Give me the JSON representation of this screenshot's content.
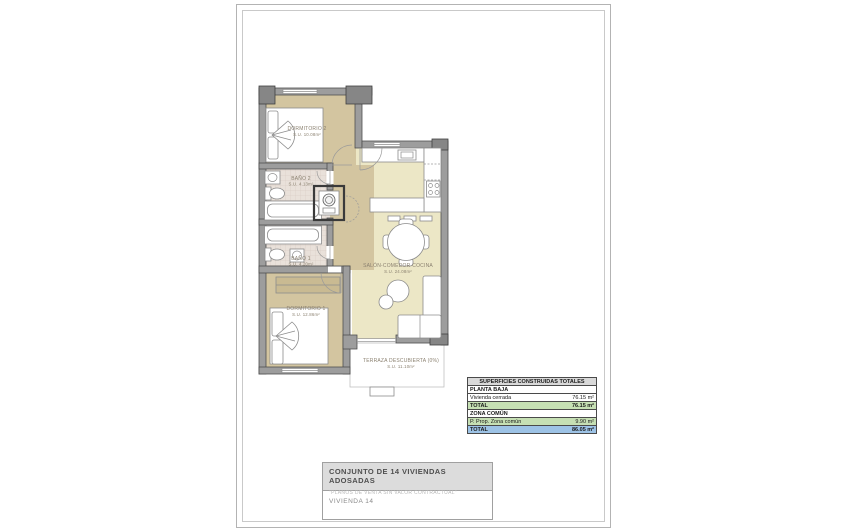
{
  "plan": {
    "rooms": [
      {
        "name": "DORMITORIO 2",
        "area": "S.U. 10.08m²"
      },
      {
        "name": "BAÑO 2",
        "area": "S.U. 4.13m²"
      },
      {
        "name": "BAÑO 1",
        "area": "S.U. 4.20m²"
      },
      {
        "name": "DORMITORIO 1",
        "area": "S.U. 12.86m²"
      },
      {
        "name": "SALÓN-COMEDOR-COCINA",
        "area": "S.U. 24.08m²"
      },
      {
        "name": "TERRAZA DESCUBIERTA (0%)",
        "area": "S.U. 11.10m²"
      }
    ]
  },
  "areas_table": {
    "title": "SUPERFICIES CONSTRUIDAS TOTALES",
    "rows": [
      {
        "label": "PLANTA BAJA",
        "value": ""
      },
      {
        "label": "Vivienda cerrada",
        "value": "76.15 m²"
      },
      {
        "label": "TOTAL",
        "value": "76.15 m²"
      },
      {
        "label": "ZONA COMÚN",
        "value": ""
      },
      {
        "label": "P. Prop. Zona común",
        "value": "9.90 m²"
      },
      {
        "label": "TOTAL",
        "value": "86.05 m²"
      }
    ],
    "colors": {
      "header_bg": "#d9d9d9",
      "subtotal_green": "#c6e0b4",
      "total_blue": "#9dc3e6"
    }
  },
  "title_block": {
    "project": "CONJUNTO DE 14 VIVIENDAS ADOSADAS",
    "disclaimer": "\"PLANOS DE VENTA SIN VALOR CONTRACTUAL\"",
    "unit": "VIVIENDA 14"
  }
}
